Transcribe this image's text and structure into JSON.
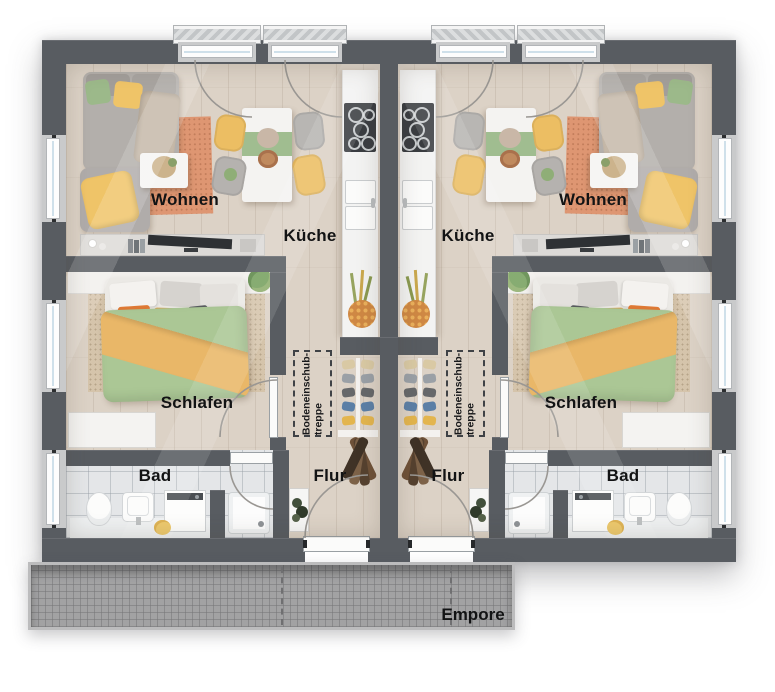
{
  "labels": {
    "wohnen": "Wohnen",
    "kueche": "Küche",
    "schlafen": "Schlafen",
    "bad": "Bad",
    "flur": "Flur",
    "treppe_line1": "Bodeneinschub-",
    "treppe_line2": "treppe",
    "empore": "Empore"
  },
  "colors": {
    "wall": "#585c61",
    "wood_floor": "#dcd2c6",
    "tile_floor": "#e4e6e8",
    "rug_living": "#de9672",
    "rug_bedroom": "#d5c4ab",
    "duvet_green": "#abc795",
    "blanket_orange": "#e9b768",
    "accent_yellow": "#ecbe63",
    "empore_gray": "#a2a2a3"
  }
}
